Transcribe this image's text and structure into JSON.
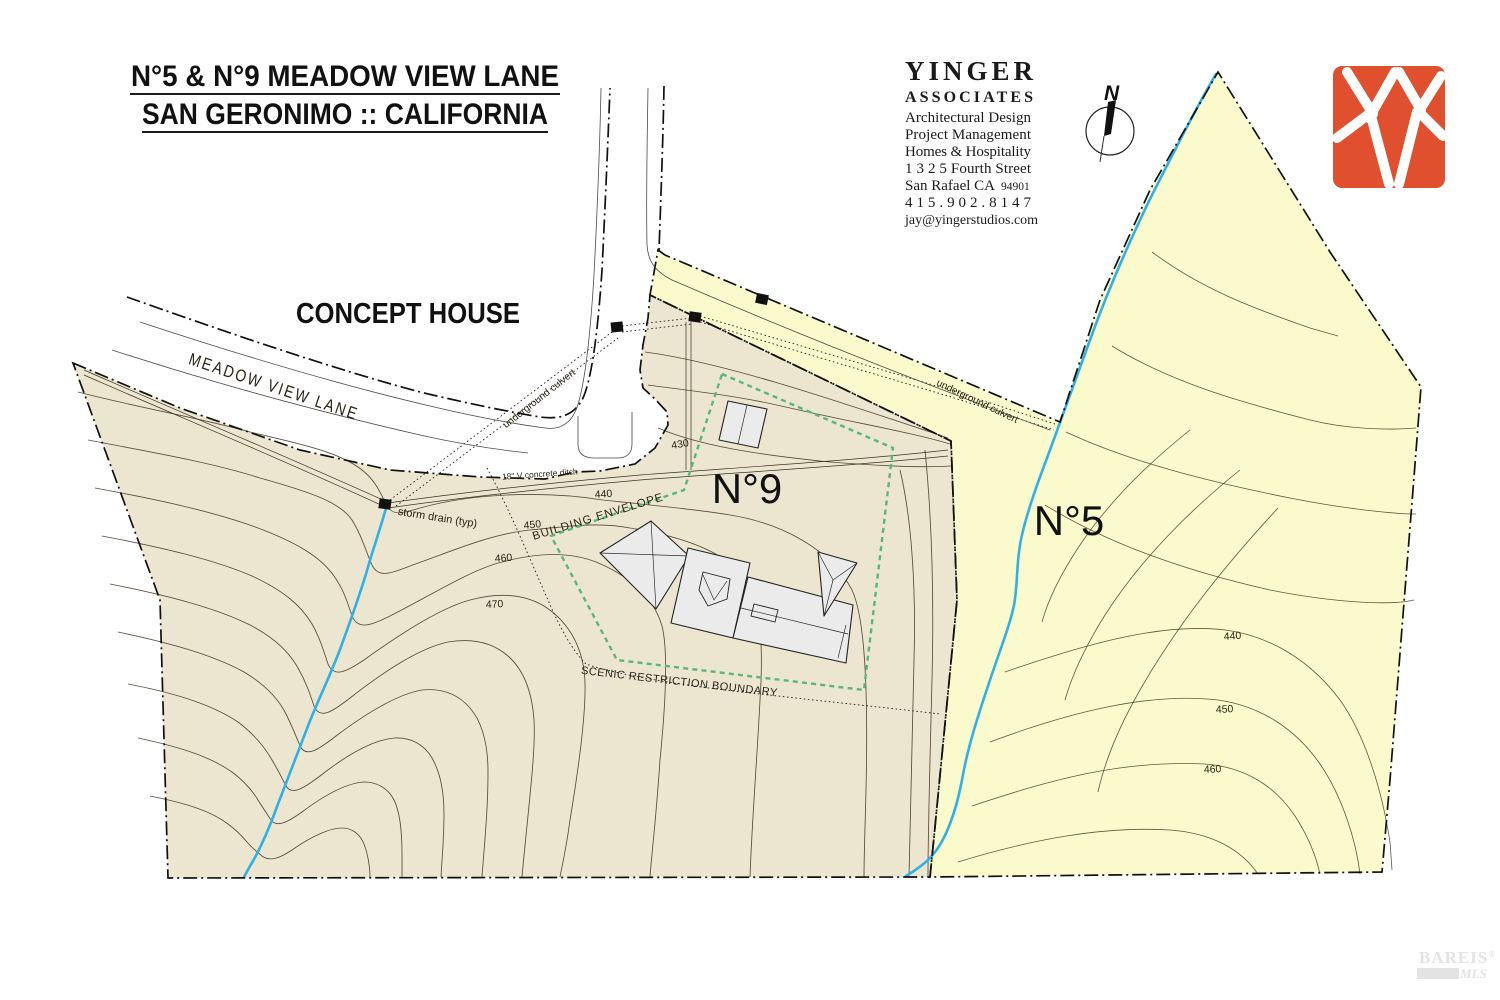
{
  "title": {
    "line1": "N°5 & N°9 MEADOW VIEW LANE",
    "line2": "SAN GERONIMO :: CALIFORNIA"
  },
  "concept_label": "CONCEPT HOUSE",
  "architect": {
    "name": "YINGER",
    "name2": "ASSOCIATES",
    "service1": "Architectural Design",
    "service2": "Project Management",
    "service3": "Homes & Hospitality",
    "address": "1 3 2 5  Fourth Street",
    "city": "San Rafael  CA",
    "zip": "94901",
    "phone": "4 1 5 . 9 0 2 . 8 1 4 7",
    "email": "jay@yingerstudios.com"
  },
  "compass": {
    "north": "N"
  },
  "road": {
    "name": "MEADOW VIEW LANE"
  },
  "parcels": {
    "n9": "N°9",
    "n5": "N°5"
  },
  "labels": {
    "storm_drain": "storm drain (typ)",
    "underground_culvert": "underground culvert",
    "ditch": "18\" V concrete ditch",
    "building_envelope": "BUILDING ENVELOPE",
    "scenic": "SCENIC RESTRICTION BOUNDARY"
  },
  "contour_labels": {
    "n9": [
      "430",
      "440",
      "450",
      "460",
      "470"
    ],
    "n5": [
      "440",
      "450",
      "460"
    ]
  },
  "watermark": {
    "name": "BAREIS",
    "reg": "®",
    "sub": "MLS"
  },
  "colors": {
    "parcel_n9": "#ece5d0",
    "parcel_n5": "#fafacd",
    "creek": "#2fb1e8",
    "envelope_green": "#58b878",
    "logo_red": "#e0502e"
  }
}
